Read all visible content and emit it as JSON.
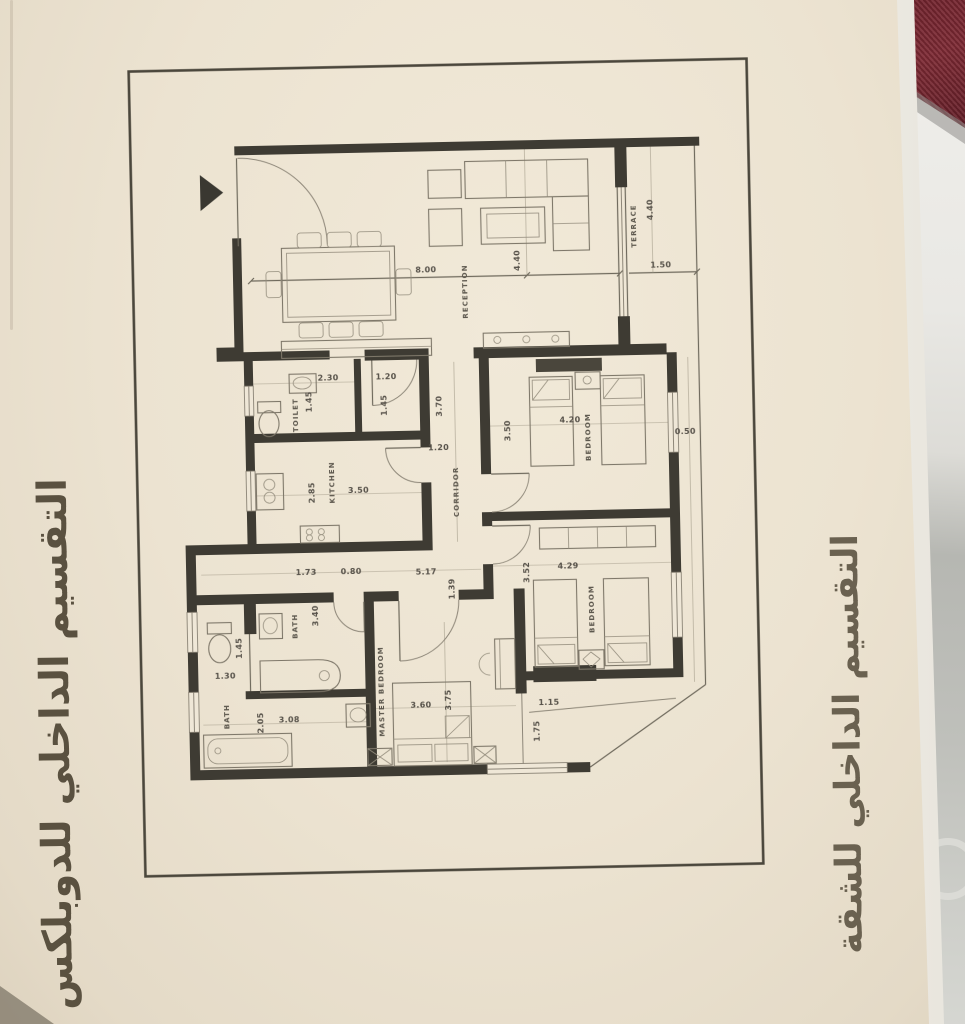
{
  "captions": {
    "right": "التقسيم الداخلي للشقة",
    "left": "التقسيم الداخلي للدوبلكس"
  },
  "plan": {
    "reception": {
      "label": "RECEPTION",
      "width": "8.00",
      "depth": "4.40"
    },
    "terrace": {
      "label": "TERRACE",
      "depth": "4.40",
      "width": "1.50",
      "side_strip": "0.50"
    },
    "toilet": {
      "label": "TOILET",
      "width": "2.30",
      "depth": "1.45"
    },
    "toilet_lobby": {
      "width": "1.20",
      "depth": "1.45"
    },
    "kitchen": {
      "label": "KITCHEN",
      "width": "3.50",
      "depth": "2.85"
    },
    "corridor": {
      "label": "CORRIDOR",
      "length": "3.70",
      "width": "1.20",
      "lower_length": "5.17",
      "lower_width": "1.39"
    },
    "bedroom_1": {
      "label": "BEDROOM",
      "width": "4.20",
      "depth": "3.50"
    },
    "bedroom_2": {
      "label": "BEDROOM",
      "width": "4.29",
      "depth": "3.52"
    },
    "rear_balcony": {
      "depth": "1.15",
      "width": "1.75"
    },
    "master_bedroom": {
      "label": "MASTER BEDROOM",
      "width": "3.60",
      "depth": "3.75"
    },
    "bath_hall": {
      "width": "1.73",
      "door": "0.80"
    },
    "bath_1": {
      "label": "BATH",
      "length": "3.40"
    },
    "bath_2": {
      "label": "BATH",
      "width": "3.08",
      "depth": "2.05",
      "wc_width": "1.30",
      "wc_depth": "1.45"
    }
  }
}
